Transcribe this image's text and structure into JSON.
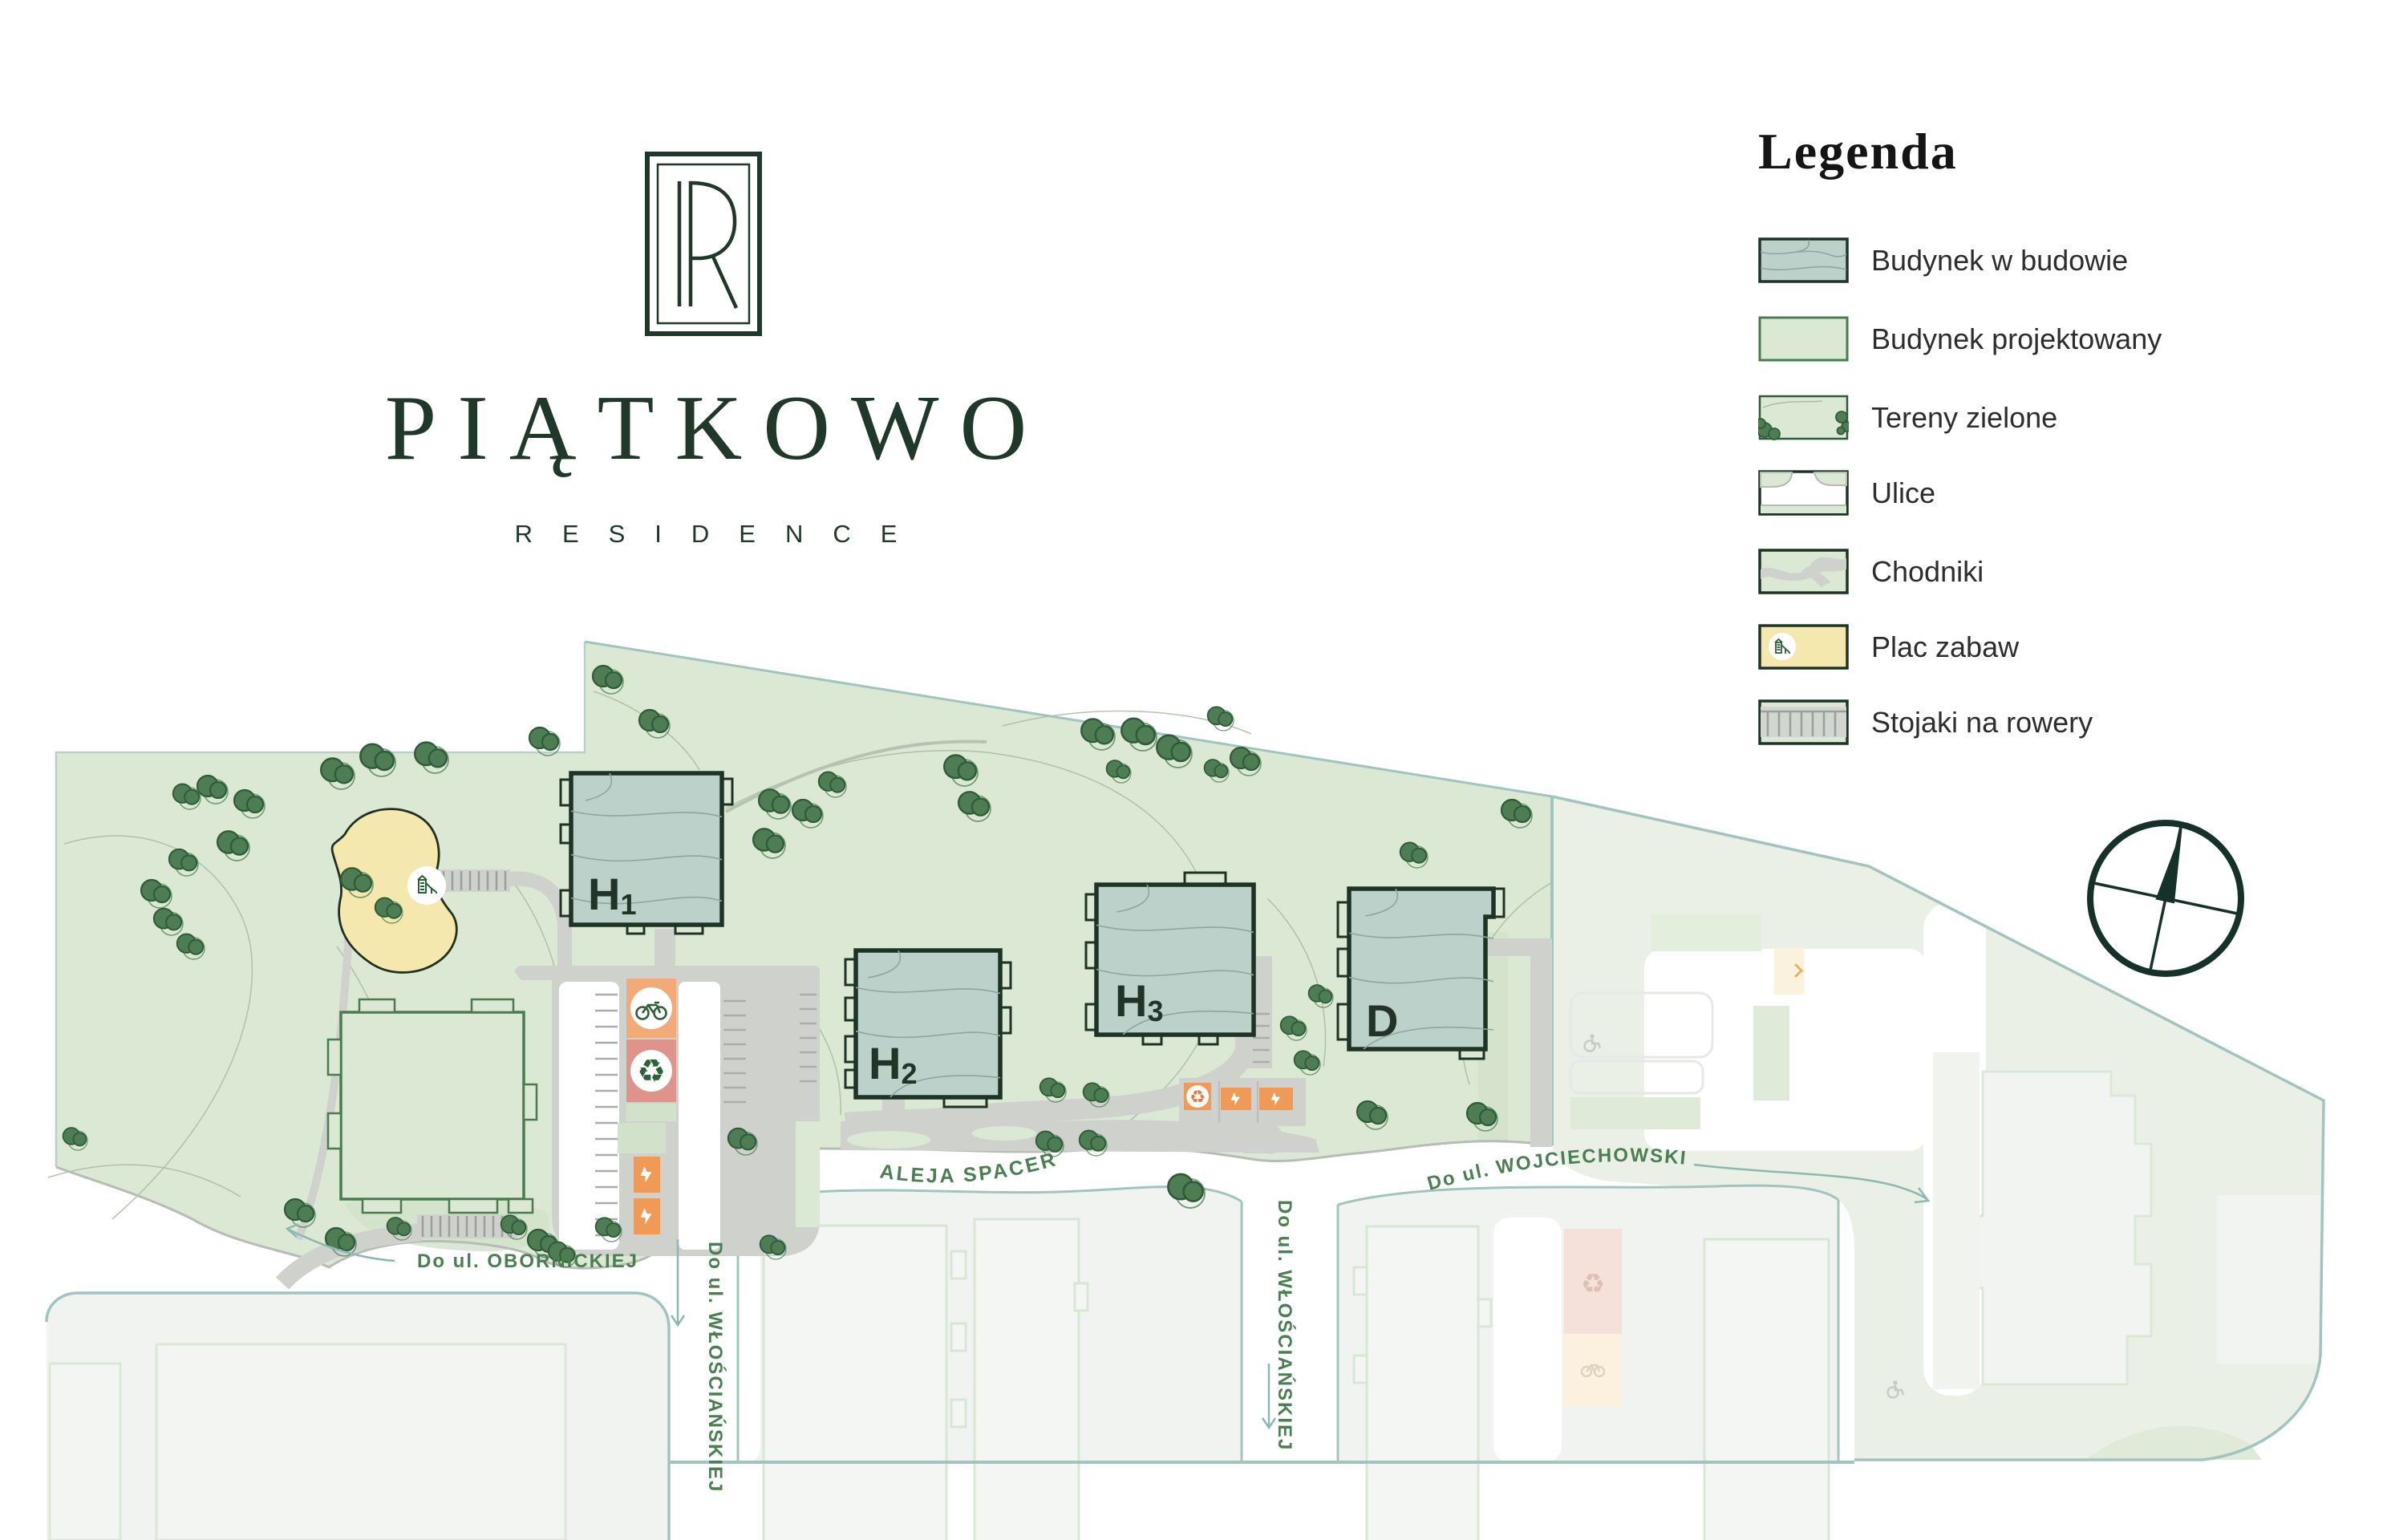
{
  "logo": {
    "monogram_letters": "PR",
    "title": "PIĄTKOWO",
    "subtitle": "RESIDENCE"
  },
  "legend": {
    "title": "Legenda",
    "items": [
      {
        "key": "under-construction",
        "label": "Budynek w budowie"
      },
      {
        "key": "planned",
        "label": "Budynek projektowany"
      },
      {
        "key": "greenery",
        "label": "Tereny zielone"
      },
      {
        "key": "streets",
        "label": "Ulice"
      },
      {
        "key": "sidewalks",
        "label": "Chodniki"
      },
      {
        "key": "playground",
        "label": "Plac zabaw"
      },
      {
        "key": "bike-racks",
        "label": "Stojaki na rowery"
      }
    ]
  },
  "map": {
    "buildings": [
      {
        "letter": "H",
        "sub": "1"
      },
      {
        "letter": "H",
        "sub": "2"
      },
      {
        "letter": "H",
        "sub": "3"
      },
      {
        "letter": "D",
        "sub": ""
      }
    ],
    "street_labels": {
      "aleja_spacerowa": "ALEJA SPACEROWA",
      "obornickiej": "Do ul. OBORNICKIEJ",
      "wloscianskiej": "Do ul. WŁOŚCIAŃSKIEJ",
      "wojciechowskiego": "Do ul. WOJCIECHOWSKIEGO"
    },
    "colors": {
      "site_green": "#dbe8d3",
      "building_teal": "#bdd1cb",
      "outline_dark": "#1e3325",
      "label_green": "#4b7e53",
      "playground_yellow": "#f4e8af",
      "orange": "#f09a58",
      "salmon": "#de948b",
      "teal_line": "#a1c4be",
      "tree_green": "#4e7d53"
    }
  }
}
